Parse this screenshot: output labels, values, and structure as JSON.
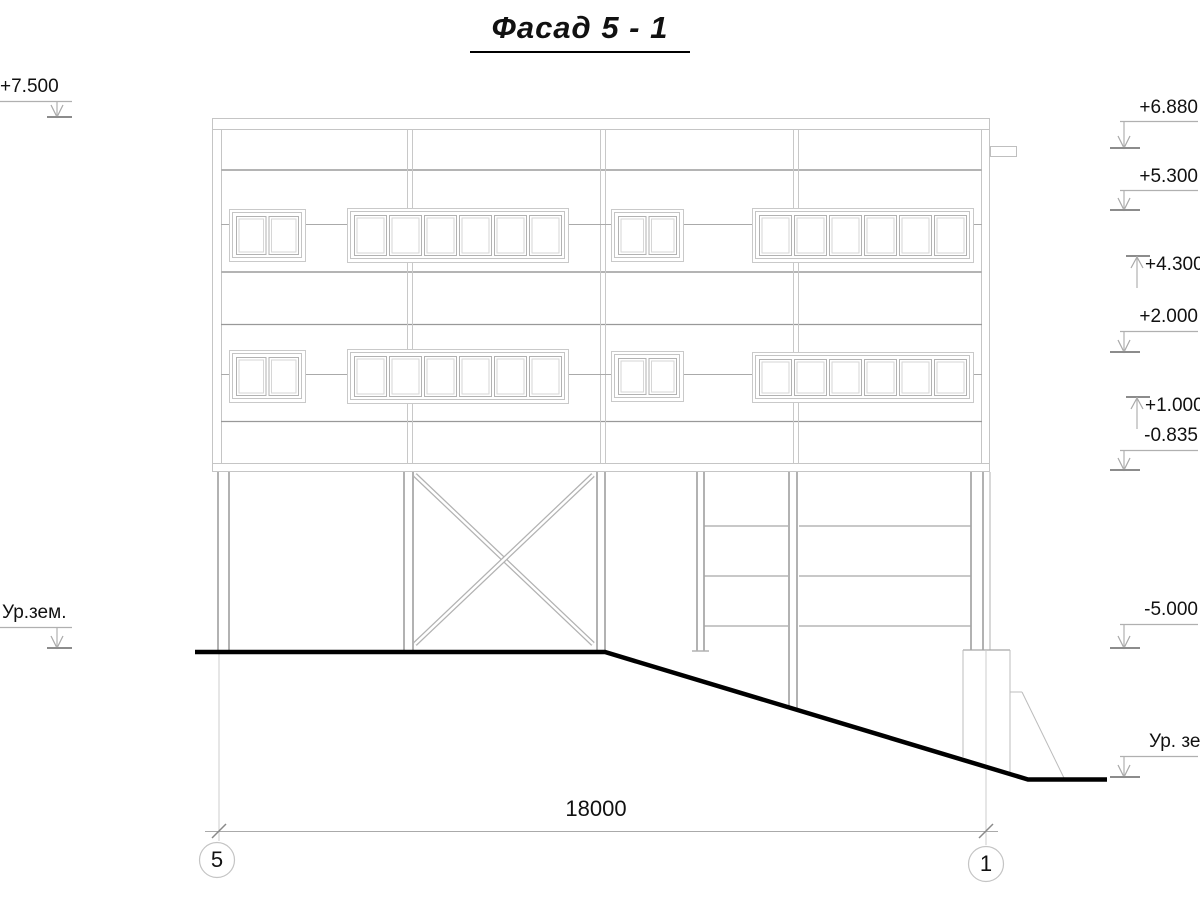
{
  "title": "Фасад 5 - 1",
  "levels": {
    "left": {
      "top": "+7.500",
      "ground": "Ур.зем."
    },
    "right": {
      "r1": "+6.880",
      "r2": "+5.300",
      "r3": "+4.300",
      "r4": "+2.000",
      "r5": "+1.000",
      "r6": "-0.835",
      "r7": "-5.000",
      "r8": "Ур. зем."
    }
  },
  "dimension": "18000",
  "axis_bubbles": {
    "left": "5",
    "right": "1"
  },
  "colors": {
    "drawing_line": "#c5c5c5",
    "band_line": "#b4b4b4",
    "structure_line": "#b2b2b2",
    "ground_line": "#000000",
    "text": "#111111"
  }
}
